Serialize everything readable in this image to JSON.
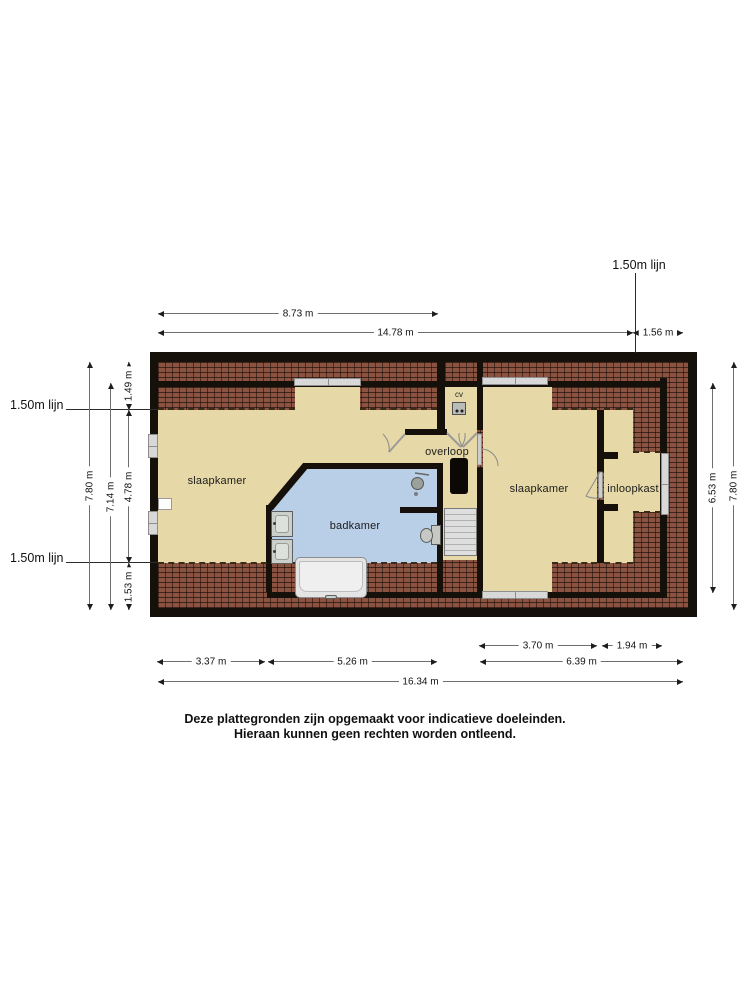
{
  "plan": {
    "rooms": {
      "bedroom_left": "slaapkamer",
      "bathroom": "badkamer",
      "landing": "overloop",
      "bedroom_right": "slaapkamer",
      "walk_in_closet": "inloopkast",
      "boiler": "cv"
    },
    "line_150_label": "1.50m lijn",
    "dimensions": {
      "top": {
        "w873": "8.73 m",
        "w1478": "14.78 m",
        "w156": "1.56 m"
      },
      "bottom": {
        "w370": "3.70 m",
        "w194": "1.94 m",
        "w337": "3.37 m",
        "w526": "5.26 m",
        "w639": "6.39 m",
        "w1634": "16.34 m"
      },
      "left": {
        "h780": "7.80 m",
        "h714": "7.14 m",
        "h149": "1.49 m",
        "h478": "4.78 m",
        "h153": "1.53 m"
      },
      "right": {
        "h653": "6.53 m",
        "h780": "7.80 m"
      }
    },
    "colors": {
      "wall": "#16100a",
      "brick": "#8a5341",
      "room": "#e6d9a7",
      "bathroom": "#b9cfe8",
      "window": "#d8d8d8"
    }
  },
  "disclaimer": {
    "line1": "Deze plattegronden zijn opgemaakt voor indicatieve doeleinden.",
    "line2": "Hieraan kunnen geen rechten worden ontleend."
  }
}
